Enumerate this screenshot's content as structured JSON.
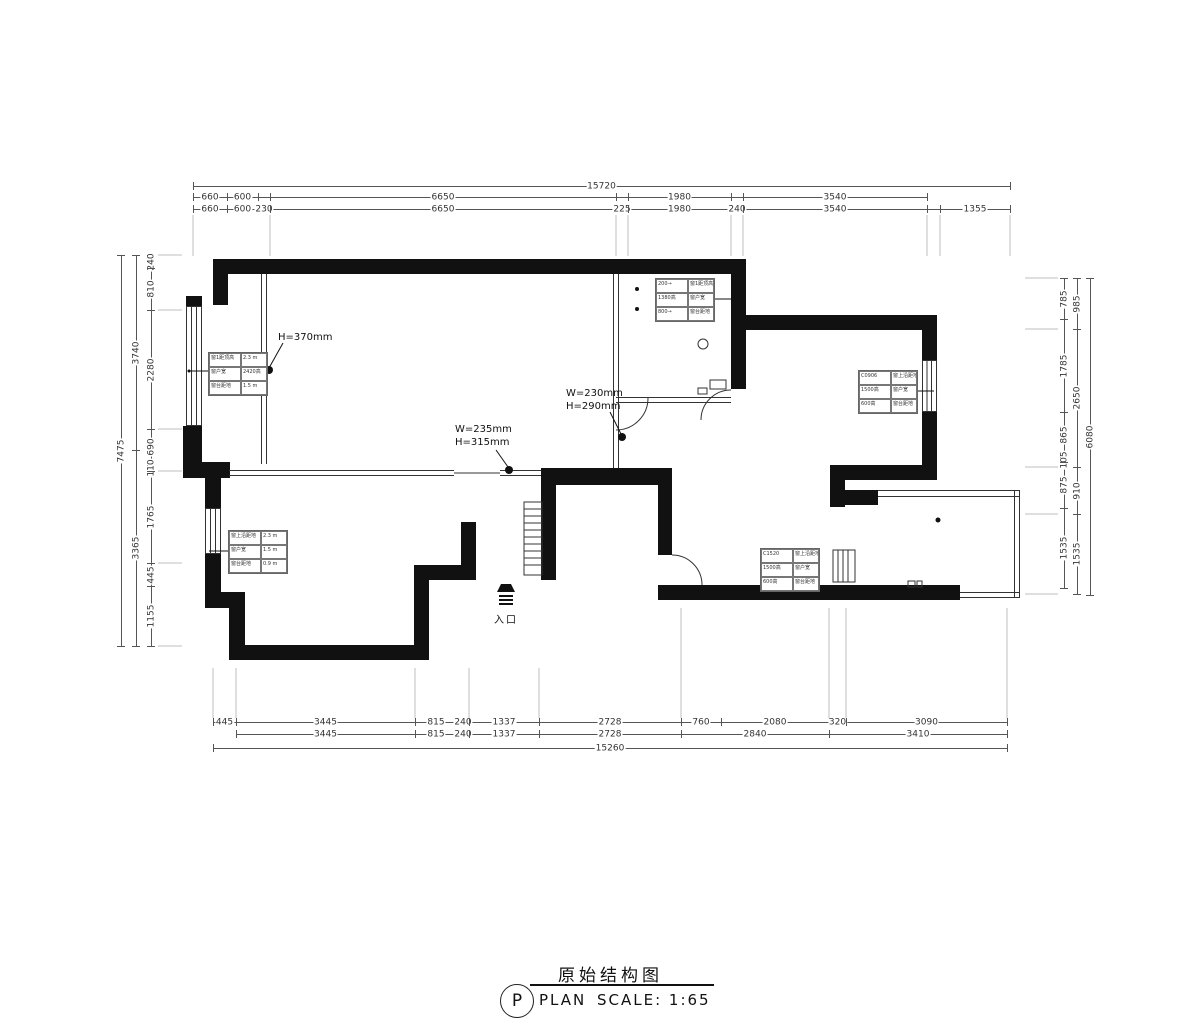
{
  "title_block": {
    "letter": "P",
    "plan_word": "PLAN",
    "drawing_title": "原始结构图",
    "scale": "SCALE:  1:65"
  },
  "entrance": {
    "label": "入口"
  },
  "callouts": {
    "h370": "H=370mm",
    "w230_line1": "W=230mm",
    "w230_line2": "H=290mm",
    "w235_line1": "W=235mm",
    "w235_line2": "H=315mm"
  },
  "dims": {
    "h_chains": [
      {
        "y": 186,
        "segs": [
          {
            "v": "15720",
            "a": 193,
            "b": 1010
          }
        ]
      },
      {
        "y": 197,
        "segs": [
          {
            "v": "660",
            "a": 193,
            "b": 227
          },
          {
            "v": "600",
            "a": 227,
            "b": 258
          },
          {
            "v": "6650",
            "a": 270,
            "b": 616
          },
          {
            "v": "1980",
            "a": 628,
            "b": 731
          },
          {
            "v": "3540",
            "a": 743,
            "b": 927
          }
        ]
      },
      {
        "y": 209,
        "segs": [
          {
            "v": "660",
            "a": 193,
            "b": 227
          },
          {
            "v": "600",
            "a": 227,
            "b": 258
          },
          {
            "v": "230",
            "a": 258,
            "b": 270
          },
          {
            "v": "6650",
            "a": 270,
            "b": 616
          },
          {
            "v": "225",
            "a": 616,
            "b": 628
          },
          {
            "v": "1980",
            "a": 628,
            "b": 731
          },
          {
            "v": "240",
            "a": 731,
            "b": 743
          },
          {
            "v": "3540",
            "a": 743,
            "b": 927
          },
          {
            "v": "1355",
            "a": 940,
            "b": 1010
          }
        ]
      },
      {
        "y": 722,
        "segs": [
          {
            "v": "445",
            "a": 213,
            "b": 236
          },
          {
            "v": "3445",
            "a": 236,
            "b": 415
          },
          {
            "v": "815",
            "a": 415,
            "b": 457
          },
          {
            "v": "240",
            "a": 457,
            "b": 469
          },
          {
            "v": "1337",
            "a": 469,
            "b": 539
          },
          {
            "v": "2728",
            "a": 539,
            "b": 681
          },
          {
            "v": "760",
            "a": 681,
            "b": 721
          },
          {
            "v": "2080",
            "a": 721,
            "b": 829
          },
          {
            "v": "320",
            "a": 829,
            "b": 846
          },
          {
            "v": "3090",
            "a": 846,
            "b": 1007
          }
        ]
      },
      {
        "y": 734,
        "segs": [
          {
            "v": "3445",
            "a": 236,
            "b": 415
          },
          {
            "v": "815",
            "a": 415,
            "b": 457
          },
          {
            "v": "240",
            "a": 457,
            "b": 469
          },
          {
            "v": "1337",
            "a": 469,
            "b": 539
          },
          {
            "v": "2728",
            "a": 539,
            "b": 681
          },
          {
            "v": "2840",
            "a": 681,
            "b": 829
          },
          {
            "v": "3410",
            "a": 829,
            "b": 1007
          }
        ]
      },
      {
        "y": 748,
        "segs": [
          {
            "v": "15260",
            "a": 213,
            "b": 1007
          }
        ]
      }
    ],
    "v_chains": [
      {
        "x": 121,
        "segs": [
          {
            "v": "7475",
            "a": 255,
            "b": 646
          }
        ]
      },
      {
        "x": 136,
        "segs": [
          {
            "v": "3740",
            "a": 255,
            "b": 450
          },
          {
            "v": "3365",
            "a": 450,
            "b": 646
          }
        ]
      },
      {
        "x": 151,
        "segs": [
          {
            "v": "240",
            "a": 255,
            "b": 268
          },
          {
            "v": "810",
            "a": 268,
            "b": 310
          },
          {
            "v": "2280",
            "a": 310,
            "b": 429
          },
          {
            "v": "690",
            "a": 429,
            "b": 465
          },
          {
            "v": "110",
            "a": 465,
            "b": 471
          },
          {
            "v": "1765",
            "a": 471,
            "b": 563
          },
          {
            "v": "445",
            "a": 563,
            "b": 586
          },
          {
            "v": "1155",
            "a": 586,
            "b": 646
          }
        ]
      },
      {
        "x": 1064,
        "segs": [
          {
            "v": "785",
            "a": 278,
            "b": 319
          },
          {
            "v": "1785",
            "a": 319,
            "b": 412
          },
          {
            "v": "865",
            "a": 412,
            "b": 457
          },
          {
            "v": "105",
            "a": 457,
            "b": 462
          },
          {
            "v": "875",
            "a": 462,
            "b": 508
          },
          {
            "v": "1535",
            "a": 508,
            "b": 588
          }
        ]
      },
      {
        "x": 1077,
        "segs": [
          {
            "v": "985",
            "a": 278,
            "b": 329
          },
          {
            "v": "2650",
            "a": 329,
            "b": 467
          },
          {
            "v": "910",
            "a": 467,
            "b": 514
          },
          {
            "v": "1535",
            "a": 514,
            "b": 594
          }
        ]
      },
      {
        "x": 1090,
        "segs": [
          {
            "v": "6080",
            "a": 278,
            "b": 595
          }
        ]
      }
    ]
  },
  "tables": [
    {
      "x": 208,
      "y": 352,
      "rows": [
        [
          "窗1距顶高",
          "2.3 m"
        ],
        [
          "窗户宽",
          "2420高"
        ],
        [
          "窗台距地",
          "1.5 m"
        ]
      ]
    },
    {
      "x": 655,
      "y": 278,
      "rows": [
        [
          "200→",
          "窗1距顶高"
        ],
        [
          "1380高",
          "窗户宽"
        ],
        [
          "800→",
          "窗台距地"
        ]
      ]
    },
    {
      "x": 858,
      "y": 370,
      "rows": [
        [
          "C0906",
          "窗上沿距地"
        ],
        [
          "1500高",
          "窗户宽"
        ],
        [
          "600高",
          "窗台距地"
        ]
      ]
    },
    {
      "x": 228,
      "y": 530,
      "rows": [
        [
          "窗上沿距地",
          "2.3 m"
        ],
        [
          "窗户宽",
          "1.5 m"
        ],
        [
          "窗台距地",
          "0.9 m"
        ]
      ]
    },
    {
      "x": 760,
      "y": 548,
      "rows": [
        [
          "C1520",
          "窗上沿距地"
        ],
        [
          "1500高",
          "窗户宽"
        ],
        [
          "600高",
          "窗台距地"
        ]
      ]
    }
  ]
}
